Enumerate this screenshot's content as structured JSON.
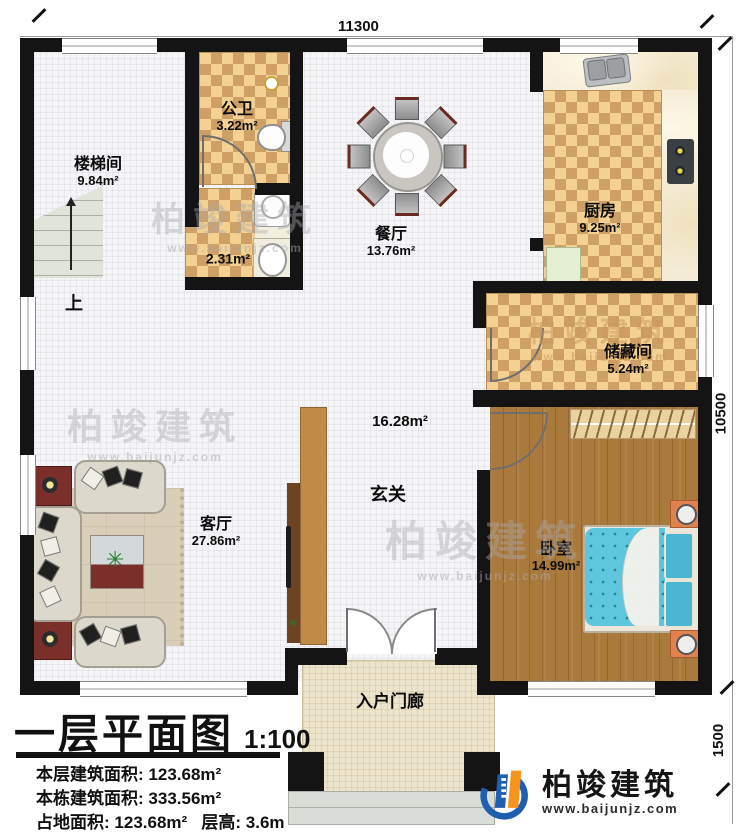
{
  "plan": {
    "title": "一层平面图",
    "scale": "1:100",
    "stairs_up_label": "上"
  },
  "dimensions": {
    "top": "11300",
    "right": "10500",
    "bottom_right": "1500"
  },
  "rooms": [
    {
      "name": "楼梯间",
      "area": "9.84m²"
    },
    {
      "name": "公卫",
      "area": "3.22m²"
    },
    {
      "name": "",
      "area": "2.31m²"
    },
    {
      "name": "餐厅",
      "area": "13.76m²"
    },
    {
      "name": "厨房",
      "area": "9.25m²"
    },
    {
      "name": "储藏间",
      "area": "5.24m²"
    },
    {
      "name": "玄关",
      "area": "16.28m²"
    },
    {
      "name": "客厅",
      "area": "27.86m²"
    },
    {
      "name": "卧室",
      "area": "14.99m²"
    },
    {
      "name": "入户门廊",
      "area": ""
    }
  ],
  "title_block": {
    "line1_label": "本层建筑面积:",
    "line1_value": "123.68m²",
    "line2_label": "本栋建筑面积:",
    "line2_value": "333.56m²",
    "line3_label": "占地面积:",
    "line3_value": "123.68m²",
    "line4_label": "层高:",
    "line4_value": "3.6m"
  },
  "brand": {
    "name": "柏竣建筑",
    "url": "www.baijunjz.com"
  },
  "colors": {
    "wall": "#141414",
    "checker_dark": "#cfa066",
    "checker_light": "#f2d193",
    "wood": "#aa7a3d",
    "bed_blue": "#5ec7dd",
    "nightstand_orange": "#e0824f",
    "brand_blue": "#1e5fb0",
    "brand_orange": "#f7941d",
    "accent_red_wood": "#7b2f2b"
  }
}
